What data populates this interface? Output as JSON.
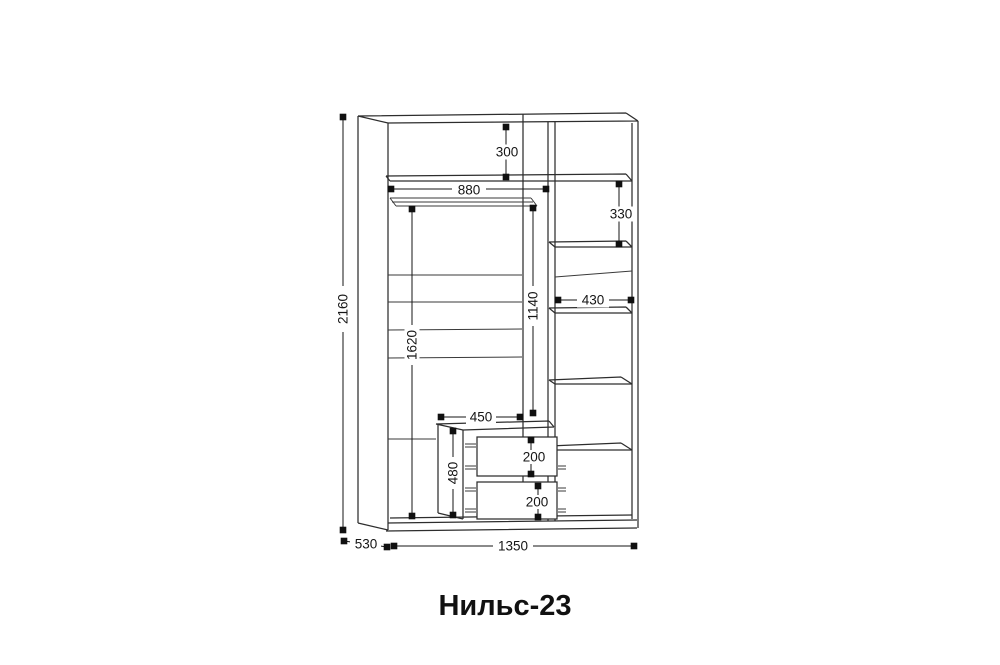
{
  "title": "Нильс-23",
  "drawing": {
    "type": "wardrobe-technical-drawing",
    "background": "#ffffff",
    "line_color": "#2d2d2d",
    "dimension_color": "#161616",
    "dims": {
      "overall_height": "2160",
      "overall_width": "1350",
      "overall_depth": "530",
      "top_shelf_drop": "300",
      "left_bay_width": "880",
      "right_shelf_gap": "330",
      "right_bay_width": "430",
      "rod_to_drawer_height": "1140",
      "hanging_height": "1620",
      "drawer_unit_width": "450",
      "drawer_unit_height": "480",
      "drawer_front_top": "200",
      "drawer_front_bottom": "200"
    }
  }
}
